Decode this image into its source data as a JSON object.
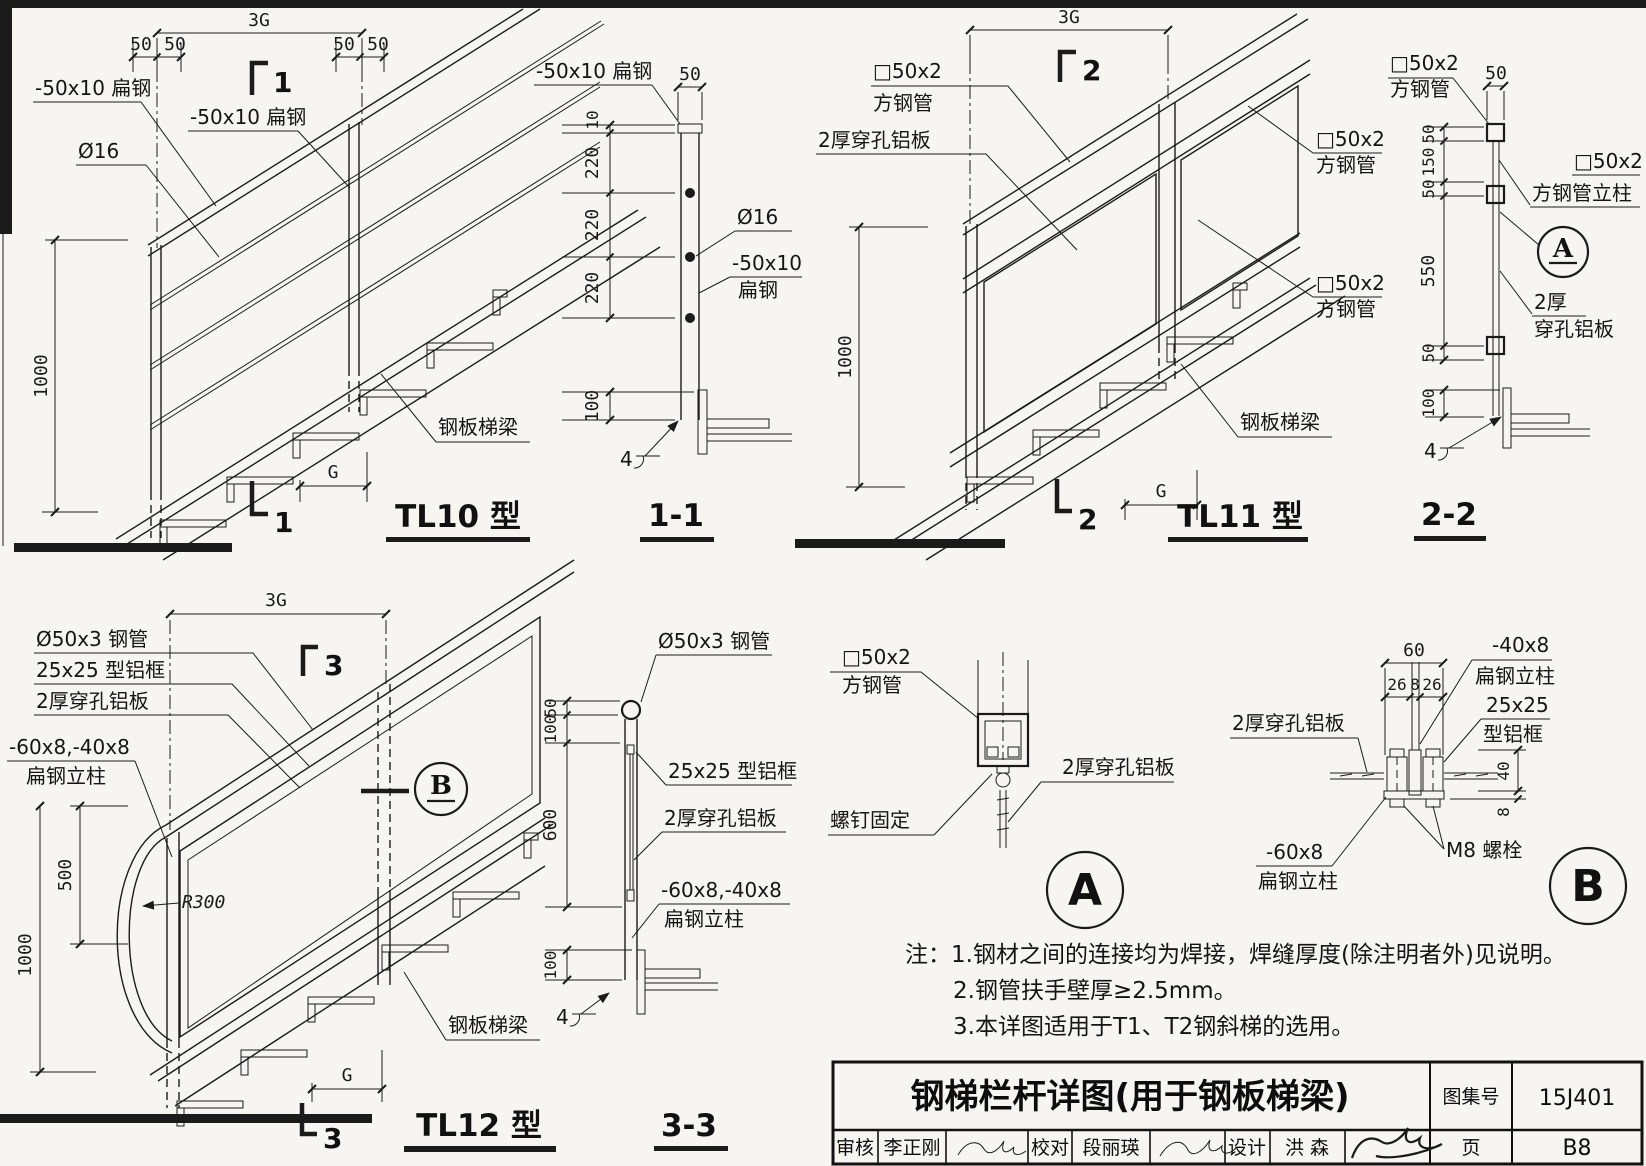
{
  "colors": {
    "paper": "#f6f5f1",
    "ink": "#1b1b1b"
  },
  "tl10": {
    "title": "TL10 型",
    "dims": {
      "g3": "3G",
      "fifty": [
        "50",
        "50",
        "50",
        "50"
      ],
      "v1000": "1000",
      "g": "G"
    },
    "labels": {
      "flat_top": "-50x10 扁钢",
      "flat_mid": "-50x10 扁钢",
      "rod": "Ø16",
      "beam": "钢板梯梁"
    },
    "cut": {
      "top": "1",
      "bottom": "1"
    }
  },
  "s11": {
    "title": "1-1",
    "labels": {
      "flat_top": "-50x10 扁钢",
      "rod": "Ø16",
      "flat1": "-50x10",
      "flat2": "扁钢"
    },
    "dims": {
      "w50": "50",
      "v": [
        "10",
        "220",
        "220",
        "220",
        "100"
      ]
    },
    "weld": "4"
  },
  "tl11": {
    "title": "TL11 型",
    "dims": {
      "g3": "3G",
      "v1000": "1000",
      "g": "G"
    },
    "labels": {
      "tube_tl1": "□50x2",
      "tube_tl2": "方钢管",
      "panel": "2厚穿孔铝板",
      "tube_r1a": "□50x2",
      "tube_r1b": "方钢管",
      "tube_r2a": "□50x2",
      "tube_r2b": "方钢管",
      "beam": "钢板梯梁"
    },
    "cut": {
      "top": "2",
      "bottom": "2"
    }
  },
  "s22": {
    "title": "2-2",
    "labels": {
      "tube_top1": "□50x2",
      "tube_top2": "方钢管",
      "w50": "50",
      "post1": "□50x2",
      "post2": "方钢管立柱",
      "panel1": "2厚",
      "panel2": "穿孔铝板"
    },
    "dims": [
      "50",
      "150",
      "50",
      "550",
      "50",
      "100"
    ],
    "marker": "A",
    "weld": "4"
  },
  "tl12": {
    "title": "TL12 型",
    "dims": {
      "g3": "3G",
      "v1000": "1000",
      "v500": "500",
      "g": "G",
      "r": "R300"
    },
    "labels": {
      "pipe": "Ø50x3 钢管",
      "frame": "25x25 型铝框",
      "panel": "2厚穿孔铝板",
      "post1": "-60x8,-40x8",
      "post2": "扁钢立柱",
      "beam": "钢板梯梁"
    },
    "cut": {
      "top": "3",
      "bottom": "3"
    },
    "marker": "B"
  },
  "s33": {
    "title": "3-3",
    "labels": {
      "pipe": "Ø50x3 钢管",
      "frame": "25x25 型铝框",
      "panel": "2厚穿孔铝板",
      "posta": "-60x8,-40x8",
      "postb": "扁钢立柱"
    },
    "dims": [
      "50",
      "100",
      "600",
      "100"
    ],
    "weld": "4"
  },
  "detail_a": {
    "labels": {
      "tube1": "□50x2",
      "tube2": "方钢管",
      "screw": "螺钉固定",
      "panel": "2厚穿孔铝板"
    },
    "marker": "A"
  },
  "detail_b": {
    "labels": {
      "panel": "2厚穿孔铝板",
      "post40a": "-40x8",
      "post40b": "扁钢立柱",
      "frame1": "25x25",
      "frame2": "型铝框",
      "post60a": "-60x8",
      "post60b": "扁钢立柱",
      "bolt": "M8 螺栓"
    },
    "dims": {
      "w60": "60",
      "w26a": "26",
      "w8": "8",
      "w26b": "26",
      "h40": "40",
      "h8": "8"
    },
    "marker": "B"
  },
  "notes": {
    "l1": "注：1.钢材之间的连接均为焊接，焊缝厚度(除注明者外)见说明。",
    "l2": "2.钢管扶手壁厚≥2.5mm。",
    "l3": "3.本详图适用于T1、T2钢斜梯的选用。"
  },
  "titleblock": {
    "title": "钢梯栏杆详图(用于钢板梯梁)",
    "atlas_label": "图集号",
    "atlas_no": "15J401",
    "page_label": "页",
    "page_no": "B8",
    "review_label": "审核",
    "review_name": "李正刚",
    "proof_label": "校对",
    "proof_name": "段丽瑛",
    "design_label": "设计",
    "design_name": "洪  森"
  }
}
